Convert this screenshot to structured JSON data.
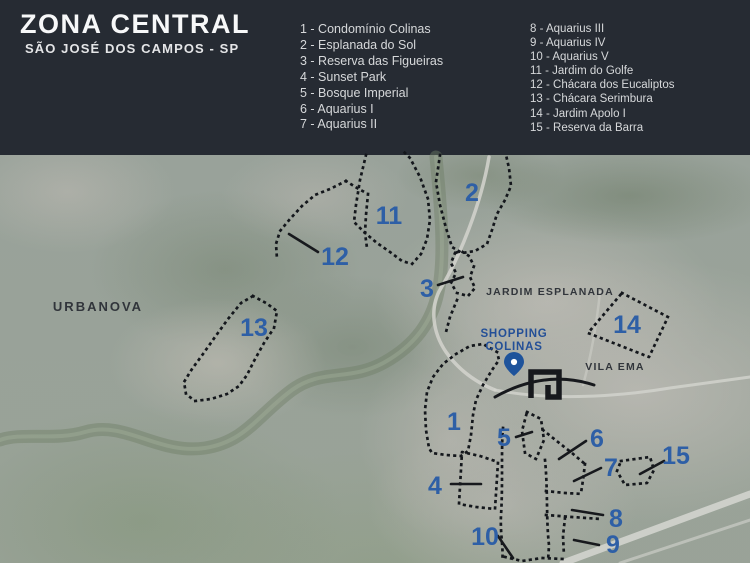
{
  "header": {
    "title": "ZONA CENTRAL",
    "subtitle": "SÃO JOSÉ DOS CAMPOS - SP",
    "legend_col1": [
      "1 - Condomínio Colinas",
      "2 - Esplanada do Sol",
      "3 - Reserva das Figueiras",
      "4 - Sunset Park",
      "5 - Bosque Imperial",
      "6 - Aquarius I",
      "7 - Aquarius II"
    ],
    "legend_col2": [
      "8 - Aquarius III",
      "9 - Aquarius IV",
      "10 - Aquarius V",
      "11 - Jardim do Golfe",
      "12 - Chácara dos Eucaliptos",
      "13 - Chácara Serimbura",
      "14 - Jardim Apolo I",
      "15 - Reserva da Barra"
    ]
  },
  "map": {
    "markers": [
      "1",
      "2",
      "3",
      "4",
      "5",
      "6",
      "7",
      "8",
      "9",
      "10",
      "11",
      "12",
      "13",
      "14",
      "15"
    ],
    "labels": {
      "urbanova": "URBANOVA",
      "jardim_esplanada": "JARDIM ESPLANADA",
      "vila_ema": "VILA EMA",
      "shopping_line1": "SHOPPING",
      "shopping_line2": "COLINAS"
    },
    "colors": {
      "header_bg": "#262b33",
      "marker_blue": "#2e5fa6",
      "shopping_blue": "#234f97",
      "outline_black": "#14171c",
      "area_label_dark": "#31353b",
      "legend_text": "#d6d8da"
    }
  }
}
